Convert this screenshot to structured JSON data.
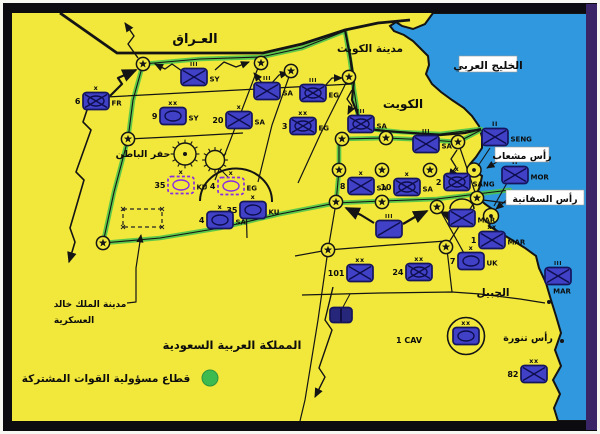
{
  "map": {
    "colors": {
      "paper": "#f8f8f2",
      "frame": "#0b0b10",
      "frame_right": "#3a2566",
      "land": "#f2e83b",
      "sea": "#2f98df",
      "line": "#141414",
      "green": "#4cc44c",
      "unit_fill": "#4141c8",
      "unit_stroke": "#15155e",
      "unit_sym": "#0e0e4e",
      "dashed": "#8a2be2",
      "dark_unit": "#26267a",
      "label_box": "#ffffff",
      "text": "#0d0d0d",
      "legend_green": "#3dbb4e"
    },
    "geometry": {
      "sea": "M433,13 L425,24 413,29 402,26 396,22 390,26 394,31 404,35 413,41 420,48 428,56 429,65 426,74 432,84 441,92 452,100 464,108 472,116 479,126 482,137 482,148 476,157 470,164 475,171 482,176 480,186 476,196 485,204 495,211 491,219 489,226 499,232 512,240 525,248 536,256 539,268 546,283 551,300 556,316 561,333 555,350 561,366 553,380 560,394 554,408 558,421 L587,421 L587,13 Z",
      "iraq_border": "M60,13 L117,53 L263,53 302,44 345,30 378,23 410,20",
      "kuwait_border": "M345,30 L350,55 354,80 352,100 358,115 360,128 L385,131 412,133 440,135 465,133 481,129",
      "green_paths": [
        "M143,64 L200,59 261,57 302,48 345,31",
        "M345,31 L350,60 354,90 360,128",
        "M360,128 L400,132 440,134 481,129",
        "M143,64 L133,100 128,139 114,192 103,243",
        "M103,243 L160,238 220,228 280,214 336,203",
        "M336,203 L382,201 437,199 477,194 510,190",
        "M339,139 L339,170 336,203",
        "M342,139 L386,138 430,140 458,142 481,130"
      ],
      "thin_lines": [
        "M88,98 L200,92 352,84",
        "M261,60 L240,115 215,180",
        "M291,71 L272,125 258,182",
        "M349,77 L320,135 298,183",
        "M128,139 L190,136 243,133",
        "M246,201 L247,238",
        "M336,203 L328,250 318,320 305,400 300,421",
        "M295,256 L328,250 390,245 446,241",
        "M302,295 L380,293 452,292 480,294 520,299 545,303",
        "M446,241 L452,292",
        "M446,247 L477,198",
        "M477,198 L458,142",
        "M483,200 L515,204",
        "M440,210 L465,255"
      ],
      "hafar_arc": "M200,201 A36,33 0 0 1 272,202",
      "dashed_rect": {
        "x": 123,
        "y": 209,
        "w": 39,
        "h": 18
      }
    },
    "stars": [
      [
        143,
        64
      ],
      [
        261,
        63
      ],
      [
        291,
        71
      ],
      [
        349,
        77
      ],
      [
        128,
        139
      ],
      [
        103,
        243
      ],
      [
        342,
        139
      ],
      [
        386,
        138
      ],
      [
        458,
        142
      ],
      [
        339,
        170
      ],
      [
        382,
        170
      ],
      [
        430,
        170
      ],
      [
        336,
        202
      ],
      [
        382,
        202
      ],
      [
        437,
        207
      ],
      [
        477,
        198
      ],
      [
        328,
        250
      ],
      [
        446,
        247
      ]
    ],
    "suns": [
      {
        "x": 185,
        "y": 154,
        "r": 11,
        "dot": true
      },
      {
        "x": 215,
        "y": 160,
        "r": 9.5,
        "dot": false
      }
    ],
    "ports": [
      {
        "x": 474,
        "y": 170,
        "r": 7
      },
      {
        "x": 491,
        "y": 216,
        "r": 7.5
      }
    ],
    "coast_dots": [
      [
        549,
        302
      ],
      [
        562,
        341
      ]
    ],
    "arrows": [
      {
        "pts": [
          [
            110,
            96
          ],
          [
            122,
            84
          ],
          [
            118,
            78
          ],
          [
            136,
            70
          ]
        ],
        "w": 2.2
      },
      {
        "pts": [
          [
            182,
            71
          ],
          [
            172,
            64
          ],
          [
            165,
            69
          ],
          [
            155,
            64
          ]
        ],
        "w": 1.3
      },
      {
        "pts": [
          [
            215,
            70
          ],
          [
            224,
            62
          ],
          [
            236,
            67
          ],
          [
            249,
            62
          ]
        ],
        "w": 1.3
      },
      {
        "pts": [
          [
            271,
            84
          ],
          [
            279,
            75
          ],
          [
            288,
            73
          ]
        ],
        "w": 1.3
      },
      {
        "pts": [
          [
            324,
            87
          ],
          [
            332,
            78
          ],
          [
            342,
            78
          ]
        ],
        "w": 1.3
      },
      {
        "pts": [
          [
            352,
            90
          ],
          [
            347,
            99
          ],
          [
            352,
            106
          ],
          [
            348,
            114
          ]
        ],
        "w": 1.3
      },
      {
        "pts": [
          [
            374,
            223
          ],
          [
            361,
            215
          ],
          [
            346,
            208
          ]
        ],
        "w": 2.2
      },
      {
        "pts": [
          [
            403,
            224
          ],
          [
            415,
            217
          ],
          [
            427,
            211
          ]
        ],
        "w": 2.2
      },
      {
        "pts": [
          [
            452,
            217
          ],
          [
            441,
            212
          ]
        ],
        "w": 1.8
      },
      {
        "pts": [
          [
            500,
            160
          ],
          [
            487,
            168
          ]
        ],
        "w": 1.2
      },
      {
        "pts": [
          [
            509,
            198
          ],
          [
            496,
            209
          ]
        ],
        "w": 1.2
      },
      {
        "pts": [
          [
            490,
            148
          ],
          [
            478,
            166
          ]
        ],
        "w": 1.1,
        "head": false
      },
      {
        "pts": [
          [
            507,
            183
          ],
          [
            494,
            206
          ]
        ],
        "w": 1.1,
        "head": false
      },
      {
        "pts": [
          [
            93,
            92
          ],
          [
            83,
            122
          ],
          [
            91,
            130
          ],
          [
            76,
            172
          ],
          [
            84,
            180
          ],
          [
            70,
            228
          ],
          [
            75,
            242
          ],
          [
            69,
            262
          ]
        ],
        "w": 1.6
      },
      {
        "pts": [
          [
            333,
            287
          ],
          [
            325,
            320
          ],
          [
            332,
            330
          ],
          [
            319,
            368
          ],
          [
            325,
            377
          ],
          [
            315,
            397
          ]
        ],
        "w": 1.4
      },
      {
        "pts": [
          [
            127,
            303
          ],
          [
            136,
            302
          ],
          [
            136,
            268
          ],
          [
            141,
            235
          ]
        ],
        "w": 1.2
      },
      {
        "pts": [
          [
            262,
            83
          ],
          [
            254,
            73
          ]
        ],
        "w": 1.3
      },
      {
        "pts": [
          [
            457,
            150
          ],
          [
            451,
            159
          ],
          [
            456,
            167
          ],
          [
            449,
            177
          ]
        ],
        "w": 1.3
      },
      {
        "pts": [
          [
            219,
            168
          ],
          [
            228,
            177
          ]
        ],
        "w": 1.0,
        "head": false
      },
      {
        "pts": [
          [
            138,
            58
          ],
          [
            128,
            44
          ],
          [
            134,
            36
          ],
          [
            125,
            23
          ]
        ],
        "w": 1.4
      },
      {
        "pts": [
          [
            343,
            307
          ],
          [
            350,
            294
          ]
        ],
        "w": 1.0,
        "head": false
      }
    ],
    "units": [
      {
        "id": "fr-6",
        "x": 96,
        "y": 101,
        "num": "6",
        "label": "FR",
        "ech": "x",
        "sym": "mech"
      },
      {
        "id": "sy",
        "x": 194,
        "y": 77,
        "label": "SY",
        "ech": "III",
        "sym": "inf"
      },
      {
        "id": "sy-9",
        "x": 173,
        "y": 116,
        "num": "9",
        "label": "SY",
        "ech": "xx",
        "sym": "armor"
      },
      {
        "id": "sa-20",
        "x": 239,
        "y": 120,
        "num": "20",
        "label": "SA",
        "ech": "x",
        "sym": "inf"
      },
      {
        "id": "sa-north",
        "x": 267,
        "y": 91,
        "label": "SA",
        "ech": "III",
        "sym": "inf"
      },
      {
        "id": "eg",
        "x": 313,
        "y": 93,
        "label": "EG",
        "ech": "III",
        "sym": "mech"
      },
      {
        "id": "eg-3",
        "x": 303,
        "y": 126,
        "num": "3",
        "label": "EG",
        "ech": "xx",
        "sym": "mech"
      },
      {
        "id": "sa-kuwait-border",
        "x": 361,
        "y": 124,
        "label": "SA",
        "ech": "III",
        "sym": "mech"
      },
      {
        "id": "sa-northeast",
        "x": 426,
        "y": 144,
        "label": "SA",
        "ech": "III",
        "sym": "inf"
      },
      {
        "id": "sa-8",
        "x": 361,
        "y": 186,
        "num": "8",
        "label": "SA",
        "ech": "x",
        "sym": "inf"
      },
      {
        "id": "sa-10",
        "x": 407,
        "y": 187,
        "num": "10",
        "label": "SA",
        "ech": "x",
        "sym": "mech"
      },
      {
        "id": "sang-2",
        "x": 457,
        "y": 182,
        "num": "2",
        "label": "SANG",
        "ech": "x",
        "sym": "mech"
      },
      {
        "id": "recon-screen",
        "x": 389,
        "y": 229,
        "ech": "III",
        "sym": "cav"
      },
      {
        "id": "mar-amphib",
        "x": 462,
        "y": 218,
        "label": "MAR",
        "sym": "inf",
        "arc": true
      },
      {
        "id": "mar-1",
        "x": 492,
        "y": 240,
        "num": "1",
        "label": "MAR",
        "ech": "xx",
        "sym": "inf"
      },
      {
        "id": "uk-7",
        "x": 471,
        "y": 261,
        "num": "7",
        "label": "UK",
        "ech": "x",
        "sym": "armor"
      },
      {
        "id": "div-101",
        "x": 360,
        "y": 273,
        "num": "101",
        "ech": "xx",
        "sym": "inf"
      },
      {
        "id": "div-24",
        "x": 419,
        "y": 272,
        "num": "24",
        "ech": "xx",
        "sym": "mech"
      },
      {
        "id": "acr",
        "x": 341,
        "y": 315,
        "sym": "bar",
        "style": "dark",
        "w": 22,
        "h": 15
      },
      {
        "id": "cav-1",
        "x": 466,
        "y": 336,
        "ech": "xx",
        "sym": "armor",
        "circled": true
      },
      {
        "id": "div-82",
        "x": 534,
        "y": 374,
        "num": "82",
        "ech": "xx",
        "sym": "inf"
      },
      {
        "id": "seng",
        "x": 495,
        "y": 137,
        "label": "SENG",
        "ech": "II",
        "sym": "inf"
      },
      {
        "id": "mor",
        "x": 515,
        "y": 175,
        "label": "MOR",
        "ech": "II",
        "sym": "inf"
      },
      {
        "id": "mar-afloat",
        "x": 558,
        "y": 276,
        "label": "MAR",
        "ech": "III",
        "sym": "inf",
        "labelBelow": true
      },
      {
        "id": "ku-35-planned",
        "x": 181,
        "y": 185,
        "num": "35",
        "label": "KU",
        "ech": "x",
        "sym": "armor",
        "style": "dashed"
      },
      {
        "id": "eg-4-planned",
        "x": 231,
        "y": 186,
        "num": "4",
        "label": "EG",
        "ech": "x",
        "sym": "armor",
        "style": "dashed"
      },
      {
        "id": "ku-35",
        "x": 253,
        "y": 210,
        "num": "35",
        "label": "KU",
        "ech": "x",
        "sym": "armor"
      },
      {
        "id": "sa-4",
        "x": 220,
        "y": 220,
        "num": "4",
        "label": "SA",
        "ech": "x",
        "sym": "armor"
      }
    ],
    "labels": [
      {
        "id": "iraq",
        "text": "العـراق",
        "x": 195,
        "y": 43,
        "size": 13
      },
      {
        "id": "kuwait-city",
        "text": "مدينة الكويت",
        "x": 370,
        "y": 52,
        "size": 10.5
      },
      {
        "id": "arabian-gulf",
        "text": "الخليج العربي",
        "x": 488,
        "y": 69,
        "size": 10.5,
        "box": {
          "w": 58,
          "h": 16
        }
      },
      {
        "id": "kuwait",
        "text": "الكويت",
        "x": 403,
        "y": 108,
        "size": 12
      },
      {
        "id": "hafar-al-batin",
        "text": "حفر الباطن",
        "x": 143,
        "y": 157,
        "size": 9.5
      },
      {
        "id": "ras-mishab",
        "text": "رأس مشعاب",
        "x": 522,
        "y": 159,
        "size": 9.5,
        "box": {
          "w": 54,
          "h": 15
        }
      },
      {
        "id": "ras-safaniya",
        "text": "رأس السفانية",
        "x": 545,
        "y": 202,
        "size": 9.5,
        "box": {
          "w": 78,
          "h": 15
        }
      },
      {
        "id": "al-jubail",
        "text": "الجبيل",
        "x": 493,
        "y": 296,
        "size": 10.5
      },
      {
        "id": "ras-tanura",
        "text": "رأس تنورة",
        "x": 528,
        "y": 341,
        "size": 9.5
      },
      {
        "id": "kkmc-line1",
        "text": "مدينة الملك خالد",
        "x": 90,
        "y": 307,
        "size": 9
      },
      {
        "id": "kkmc-line2",
        "text": "العسكرية",
        "x": 74,
        "y": 323,
        "size": 9
      },
      {
        "id": "saudi-arabia",
        "text": "المملكة العربية السعودية",
        "x": 232,
        "y": 349,
        "size": 11.5
      },
      {
        "id": "cav-1-caption",
        "text": "1 CAV",
        "x": 409,
        "y": 343,
        "size": 8,
        "latin": true
      }
    ],
    "legend": {
      "text": "قطاع مسؤولية القوات المشتركة",
      "text_x": 106,
      "text_y": 382,
      "size": 10.5,
      "dot_x": 210,
      "dot_y": 378,
      "dot_r": 8
    }
  }
}
